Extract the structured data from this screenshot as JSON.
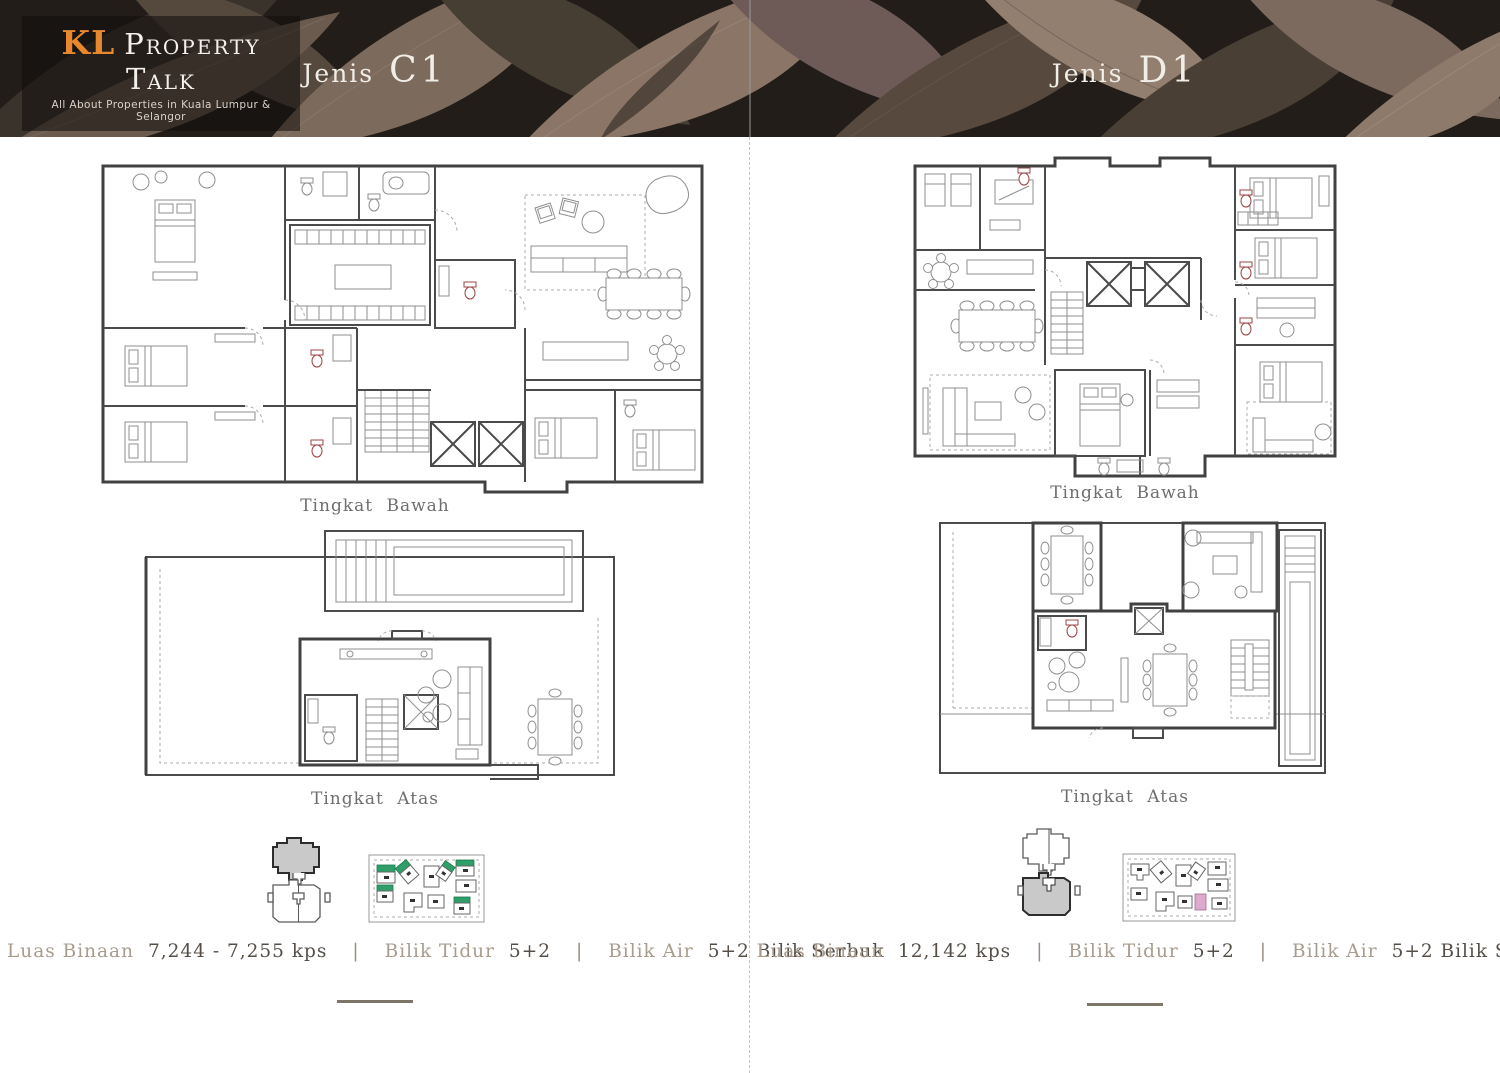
{
  "brand": {
    "initials": "KL",
    "name": "Property Talk",
    "tagline": "All About Properties in Kuala Lumpur & Selangor"
  },
  "panels": [
    {
      "title_prefix": "Jenis",
      "title": "C1",
      "lower_floor_label": "Tingkat Bawah",
      "upper_floor_label": "Tingkat Atas",
      "info": {
        "area_label": "Luas Binaan",
        "area_value": "7,244 - 7,255 kps",
        "sep1": "|",
        "bedrooms_label": "Bilik Tidur",
        "bedrooms_value": "5+2",
        "sep2": "|",
        "bathrooms_label": "Bilik Air",
        "bathrooms_value": "5+2 Bilik Serbuk"
      }
    },
    {
      "title_prefix": "Jenis",
      "title": "D1",
      "lower_floor_label": "Tingkat Bawah",
      "upper_floor_label": "Tingkat Atas",
      "info": {
        "area_label": "Luas Binaan",
        "area_value": "12,142 kps",
        "sep1": "|",
        "bedrooms_label": "Bilik Tidur",
        "bedrooms_value": "5+2",
        "sep2": "|",
        "bathrooms_label": "Bilik Air",
        "bathrooms_value": "5+2 Bilik Serbuk"
      }
    }
  ],
  "colors": {
    "accent_orange": "#e8872e",
    "info_label": "#a89c8d",
    "info_value": "#554f48",
    "floor_label": "#6e6e6e",
    "plan_wall": "#414141",
    "key_highlight_gray": "#c9c9c9",
    "highlight_green": "#2f9e68",
    "highlight_pink": "#dcaacd",
    "divider": "#c4c4c4",
    "end_line": "#7d7567"
  }
}
